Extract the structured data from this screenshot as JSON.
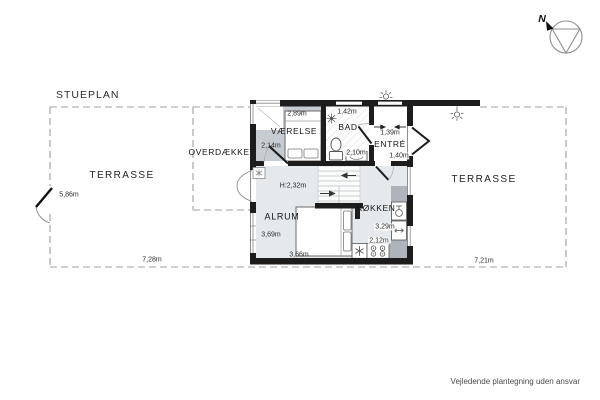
{
  "meta": {
    "title": "STUEPLAN",
    "disclaimer": "Vejledende plantegning uden ansvar",
    "compass": {
      "label": "N"
    }
  },
  "outdoor": {
    "terrace_left": {
      "label": "TERRASSE",
      "width_bottom": "7,28m",
      "gate_width": "5,86m"
    },
    "covered_area": {
      "label": "OVERDÆKKET"
    },
    "terrace_right": {
      "label": "TERRASSE",
      "width_bottom": "7,21m"
    }
  },
  "rooms": {
    "vaerelse": {
      "label": "VÆRELSE",
      "width": "2,89m",
      "depth": "2,14m"
    },
    "bad": {
      "label": "BAD",
      "width": "1,42m",
      "width_inner": "2,10m"
    },
    "entre": {
      "label": "ENTRÉ",
      "width": "1,39m",
      "depth": "1,40m"
    },
    "hall": {
      "ceiling_height": "H:2,32m"
    },
    "alrum": {
      "label": "ALRUM",
      "depth": "3,69m",
      "width": "3,66m"
    },
    "koekken": {
      "label": "KØKKEN",
      "depth": "3,29m",
      "width": "2,12m"
    }
  },
  "icons": {
    "compass": "north-arrow-in-circle",
    "lamps": "outdoor-wall-light",
    "freezer": "snowflake",
    "stove": "four-burners",
    "bathroom": [
      "shower-head",
      "toilet",
      "washbasin"
    ],
    "stairs": "u-stair-with-direction-arrows"
  },
  "colors": {
    "wall": "#1d1d1d",
    "floor_light": "#e5e9ec",
    "floor_bedroom": "#c7ccd2",
    "counter": "#aeb4ba",
    "dashed_boundary": "#9ba0a5"
  }
}
